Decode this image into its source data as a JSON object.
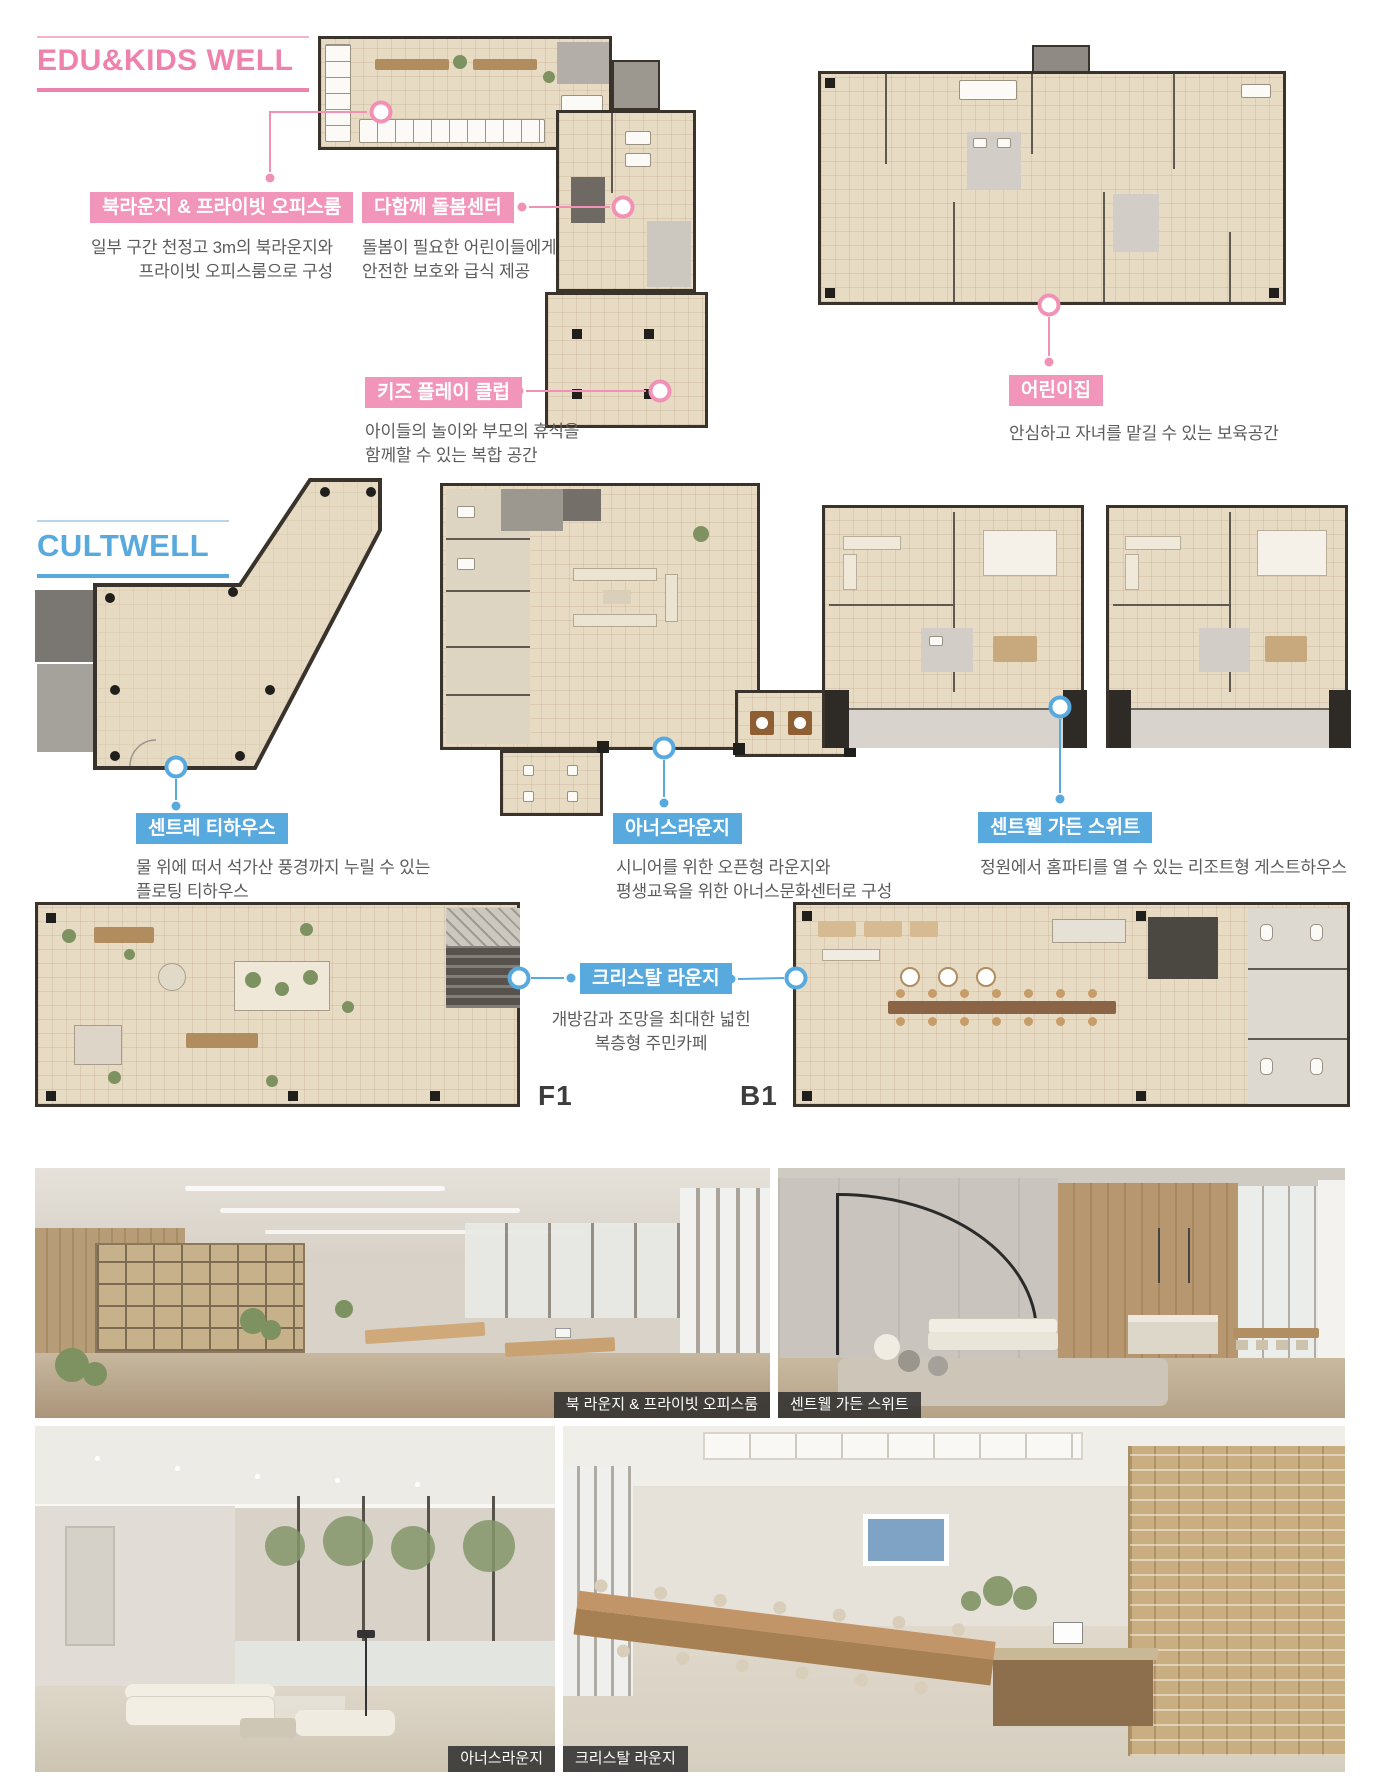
{
  "edu": {
    "title": "EDU&KIDS WELL",
    "accent": "#ee82ac",
    "label_bg": "#f295ba",
    "labels": {
      "book_lounge": {
        "title": "북라운지 & 프라이빗 오피스룸",
        "desc": [
          "일부 구간 천정고 3m의 북라운지와",
          "프라이빗 오피스룸으로 구성"
        ]
      },
      "care_center": {
        "title": "다함께 돌봄센터",
        "desc": [
          "돌봄이 필요한 어린이들에게",
          "안전한 보호와 급식 제공"
        ]
      },
      "kids_play_club": {
        "title": "키즈 플레이 클럽",
        "desc": [
          "아이들의 놀이와 부모의 휴식을",
          "함께할 수 있는 복합 공간"
        ]
      },
      "daycare": {
        "title": "어린이집",
        "desc": [
          "안심하고 자녀를 맡길 수 있는 보육공간"
        ]
      }
    }
  },
  "cult": {
    "title": "CULTWELL",
    "accent": "#58a9de",
    "label_bg": "#58a9de",
    "labels": {
      "tea_house": {
        "title": "센트레 티하우스",
        "desc": [
          "물 위에 떠서 석가산 풍경까지 누릴 수 있는",
          "플로팅 티하우스"
        ]
      },
      "honors_lounge": {
        "title": "아너스라운지",
        "desc": [
          "시니어를 위한 오픈형 라운지와",
          "평생교육을 위한 아너스문화센터로 구성"
        ]
      },
      "garden_suite": {
        "title": "센트웰 가든 스위트",
        "desc": [
          "정원에서 홈파티를 열 수 있는 리조트형 게스트하우스"
        ]
      },
      "crystal_lounge": {
        "title": "크리스탈 라운지",
        "desc": [
          "개방감과 조망을 최대한 넓힌",
          "복층형 주민카페"
        ]
      }
    },
    "floor_tags": {
      "f1": "F1",
      "b1": "B1"
    }
  },
  "photos": {
    "book_lounge_caption": "북 라운지 & 프라이빗 오피스룸",
    "garden_suite_caption": "센트웰 가든 스위트",
    "honors_lounge_caption": "아너스라운지",
    "crystal_lounge_caption": "크리스탈 라운지"
  }
}
